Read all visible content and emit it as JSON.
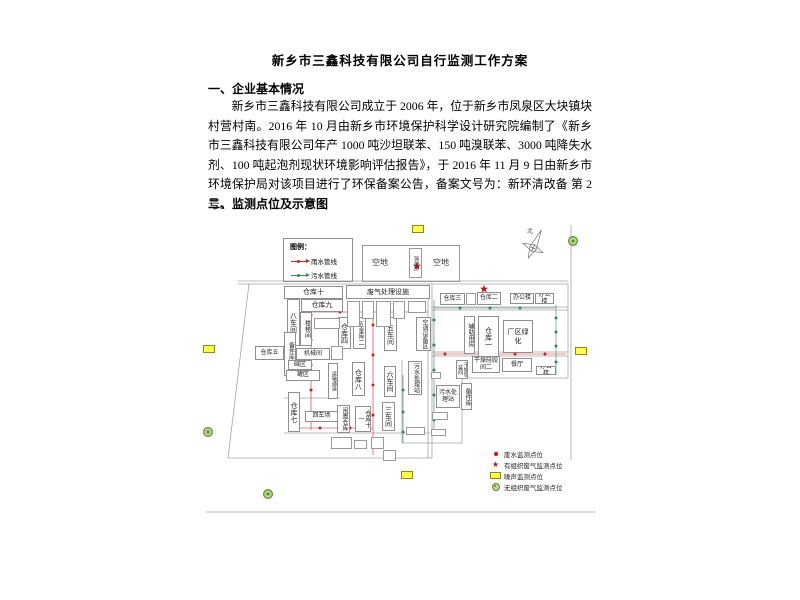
{
  "document": {
    "title": "新乡市三鑫科技有限公司自行监测工作方案",
    "section1_heading": "一、企业基本情况",
    "paragraph": "新乡市三鑫科技有限公司成立于 2006 年，位于新乡市凤泉区大块镇块村营村南。2016 年 10 月由新乡市环境保护科学设计研究院编制了《新乡市三鑫科技有限公司年产 1000 吨沙坦联苯、150 吨溴联苯、3000 吨降失水剂、100 吨起泡剂现状环境影响评估报告》，于 2016 年 11 月 9 日由新乡市环境保护局对该项目进行了环保备案公告，备案文号为：新环清改备 第 2 号。",
    "section2_heading": "二、监测点位及示意图"
  },
  "diagram": {
    "pipe_legend": {
      "title": "图例：",
      "items": [
        {
          "label": "雨水管线",
          "color": "#cc2222"
        },
        {
          "label": "污水管线",
          "color": "#2e8b57"
        }
      ]
    },
    "open_area": {
      "left": "空地",
      "right": "空地",
      "boiler": "锅炉房"
    },
    "compass": {
      "label": "北",
      "x": 533,
      "y": 248
    },
    "marker_legend": [
      {
        "symbol": "dot",
        "label": "废水监测点位"
      },
      {
        "symbol": "star",
        "label": "有组织废气监测点位"
      },
      {
        "symbol": "rect",
        "label": "噪声监测点位"
      },
      {
        "symbol": "circle",
        "label": "无组织废气监测点位"
      }
    ],
    "colors": {
      "rain": "#cc2222",
      "sewage": "#2e8b57",
      "noise_fill": "#ffff44",
      "noise_border": "#8a8a20",
      "gas_fill": "#b5d78a",
      "gas_border": "#5f8f2f",
      "line": "#a5a5a5",
      "star": "#cc1111",
      "dot": "#cc1111"
    },
    "rooms": [
      {
        "label": "仓库十",
        "x": 284,
        "y": 286,
        "w": 59,
        "h": 13
      },
      {
        "label": "仓库九",
        "x": 301,
        "y": 299,
        "w": 42,
        "h": 13
      },
      {
        "label": "八车间",
        "x": 287,
        "y": 299,
        "w": 13,
        "h": 47,
        "v": 1
      },
      {
        "label": "楼梯间",
        "x": 300,
        "y": 312,
        "w": 12,
        "h": 34,
        "v": 1,
        "fs": 6
      },
      {
        "label": "备件库二",
        "x": 284,
        "y": 332,
        "w": 12,
        "h": 44,
        "v": 1,
        "fs": 6
      },
      {
        "label": "仓库五",
        "x": 255,
        "y": 346,
        "w": 29,
        "h": 14,
        "fs": 6
      },
      {
        "label": "机械间",
        "x": 296,
        "y": 348,
        "w": 34,
        "h": 12,
        "fs": 6
      },
      {
        "label": "碱区",
        "x": 288,
        "y": 360,
        "w": 24,
        "h": 10,
        "fs": 6
      },
      {
        "label": "罐区",
        "x": 286,
        "y": 370,
        "w": 34,
        "h": 11,
        "fs": 6
      },
      {
        "label": "废气处理设施",
        "x": 346,
        "y": 285,
        "w": 84,
        "h": 14,
        "fs": 7
      },
      {
        "label": "仓库四",
        "x": 338,
        "y": 317,
        "w": 13,
        "h": 32,
        "v": 1
      },
      {
        "label": "五金库二",
        "x": 353,
        "y": 317,
        "w": 13,
        "h": 32,
        "v": 1,
        "fs": 6
      },
      {
        "label": "五车间",
        "x": 384,
        "y": 317,
        "w": 13,
        "h": 34,
        "v": 1
      },
      {
        "label": "空调设备区",
        "x": 416,
        "y": 317,
        "w": 15,
        "h": 34,
        "v": 1,
        "fs": 6
      },
      {
        "label": "仓库三",
        "x": 440,
        "y": 293,
        "w": 25,
        "h": 12,
        "fs": 6
      },
      {
        "label": "仓库二",
        "x": 477,
        "y": 292,
        "w": 24,
        "h": 13,
        "fs": 6
      },
      {
        "label": "办公楼",
        "x": 510,
        "y": 293,
        "w": 24,
        "h": 11,
        "fs": 6
      },
      {
        "label": "办公楼",
        "x": 535,
        "y": 293,
        "w": 19,
        "h": 11,
        "fs": 6
      },
      {
        "label": "辅助用房",
        "x": 464,
        "y": 316,
        "w": 11,
        "h": 38,
        "v": 1,
        "fs": 6
      },
      {
        "label": "仓库一",
        "x": 478,
        "y": 316,
        "w": 21,
        "h": 42,
        "v": 1
      },
      {
        "label": "厂区绿化",
        "x": 503,
        "y": 320,
        "w": 30,
        "h": 33,
        "fs": 7
      },
      {
        "label": "餐厅",
        "x": 502,
        "y": 358,
        "w": 30,
        "h": 14,
        "fs": 6
      },
      {
        "label": "办公楼",
        "x": 536,
        "y": 366,
        "w": 20,
        "h": 9,
        "fs": 6
      },
      {
        "label": "干燥硅胶间二",
        "x": 472,
        "y": 356,
        "w": 28,
        "h": 17,
        "fs": 6
      },
      {
        "label": "干燥包装间",
        "x": 456,
        "y": 360,
        "w": 12,
        "h": 19,
        "v": 1,
        "fs": 5
      },
      {
        "label": "运输通道",
        "x": 328,
        "y": 363,
        "w": 10,
        "h": 36,
        "v": 1,
        "fs": 5
      },
      {
        "label": "仓库八",
        "x": 352,
        "y": 362,
        "w": 13,
        "h": 34,
        "v": 1
      },
      {
        "label": "六车间",
        "x": 384,
        "y": 366,
        "w": 12,
        "h": 31,
        "v": 1
      },
      {
        "label": "污水处理站",
        "x": 408,
        "y": 361,
        "w": 14,
        "h": 34,
        "v": 1,
        "fs": 6
      },
      {
        "label": "三车间",
        "x": 382,
        "y": 402,
        "w": 13,
        "h": 29,
        "v": 1
      },
      {
        "label": "仓库七",
        "x": 288,
        "y": 392,
        "w": 12,
        "h": 40,
        "v": 1
      },
      {
        "label": "回车场",
        "x": 305,
        "y": 411,
        "w": 33,
        "h": 11,
        "fs": 6
      },
      {
        "label": "闲置仓库",
        "x": 337,
        "y": 405,
        "w": 13,
        "h": 28,
        "v": 1,
        "fs": 6
      },
      {
        "label": "仓库十一",
        "x": 355,
        "y": 406,
        "w": 16,
        "h": 26,
        "v": 1,
        "fs": 6
      },
      {
        "label": "污水处理站",
        "x": 436,
        "y": 385,
        "w": 24,
        "h": 23,
        "fs": 6
      },
      {
        "label": "备件库",
        "x": 461,
        "y": 383,
        "w": 11,
        "h": 27,
        "v": 1,
        "fs": 6
      }
    ],
    "small_boxes": [
      [
        314,
        318,
        26,
        11
      ],
      [
        331,
        346,
        12,
        14
      ],
      [
        466,
        293,
        10,
        12
      ],
      [
        347,
        301,
        13,
        26
      ],
      [
        362,
        301,
        12,
        18
      ],
      [
        376,
        301,
        15,
        26
      ],
      [
        393,
        301,
        12,
        18
      ],
      [
        408,
        301,
        18,
        12
      ],
      [
        331,
        437,
        21,
        12
      ],
      [
        354,
        440,
        13,
        9
      ],
      [
        371,
        437,
        13,
        12
      ],
      [
        383,
        450,
        13,
        11
      ],
      [
        406,
        427,
        19,
        8
      ],
      [
        431,
        429,
        15,
        7
      ],
      [
        432,
        412,
        16,
        8
      ],
      [
        431,
        372,
        10,
        7
      ]
    ],
    "gray_lines": [
      [
        238,
        281,
        568,
        281
      ],
      [
        238,
        284,
        568,
        284
      ],
      [
        249,
        284,
        228,
        458
      ],
      [
        228,
        458,
        432,
        458
      ],
      [
        428,
        284,
        428,
        458
      ],
      [
        432,
        284,
        432,
        458
      ],
      [
        568,
        284,
        568,
        378
      ],
      [
        571,
        225,
        571,
        460
      ],
      [
        432,
        307,
        568,
        307
      ],
      [
        432,
        310,
        568,
        310
      ],
      [
        432,
        352,
        568,
        352
      ],
      [
        432,
        356,
        568,
        356
      ],
      [
        462,
        378,
        568,
        378
      ],
      [
        462,
        378,
        462,
        443
      ],
      [
        402,
        443,
        462,
        443
      ],
      [
        402,
        360,
        402,
        443
      ],
      [
        284,
        398,
        340,
        398
      ],
      [
        284,
        433,
        430,
        433
      ],
      [
        206,
        512,
        596,
        512
      ]
    ],
    "rain_lines": [
      [
        311,
        300,
        311,
        430
      ],
      [
        311,
        312,
        428,
        312
      ],
      [
        373,
        302,
        373,
        455
      ],
      [
        434,
        354,
        566,
        354
      ],
      [
        300,
        428,
        373,
        428
      ]
    ],
    "sewage_lines": [
      [
        434,
        300,
        434,
        430
      ],
      [
        556,
        305,
        556,
        375
      ],
      [
        434,
        308,
        556,
        308
      ],
      [
        403,
        375,
        403,
        443
      ]
    ],
    "rain_dots": [
      [
        311,
        315
      ],
      [
        311,
        340
      ],
      [
        311,
        365
      ],
      [
        311,
        390
      ],
      [
        311,
        415
      ],
      [
        340,
        312
      ],
      [
        370,
        312
      ],
      [
        400,
        312
      ],
      [
        373,
        325
      ],
      [
        373,
        355
      ],
      [
        373,
        385
      ],
      [
        373,
        415
      ],
      [
        373,
        445
      ],
      [
        445,
        354
      ],
      [
        480,
        354
      ],
      [
        515,
        354
      ],
      [
        545,
        354
      ],
      [
        320,
        428
      ],
      [
        350,
        428
      ]
    ],
    "sewage_dots": [
      [
        434,
        320
      ],
      [
        434,
        345
      ],
      [
        434,
        370
      ],
      [
        434,
        395
      ],
      [
        434,
        420
      ],
      [
        556,
        318
      ],
      [
        556,
        332
      ],
      [
        556,
        346
      ],
      [
        556,
        362
      ],
      [
        460,
        308
      ],
      [
        490,
        308
      ],
      [
        520,
        308
      ],
      [
        403,
        390
      ],
      [
        403,
        412
      ],
      [
        403,
        432
      ]
    ],
    "organized_gas_points": [
      [
        383,
        291
      ],
      [
        484,
        289
      ],
      [
        417,
        266
      ]
    ],
    "noise_points": [
      [
        418,
        229
      ],
      [
        209,
        349
      ],
      [
        581,
        351
      ],
      [
        407,
        475
      ]
    ],
    "unorganized_gas_points": [
      [
        573,
        241
      ],
      [
        208,
        432
      ],
      [
        268,
        494
      ]
    ]
  }
}
